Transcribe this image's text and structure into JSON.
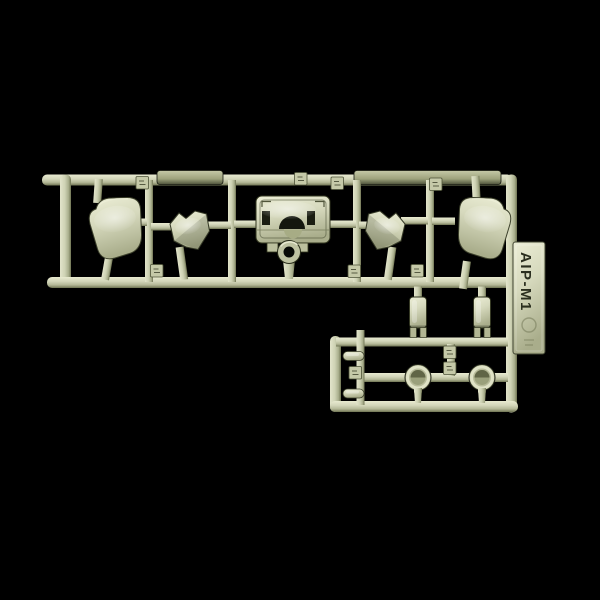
{
  "scene": {
    "description": "photograph of a plastic model kit sprue on black background",
    "background": "#000000"
  },
  "colors": {
    "plastic_light": "#e6e8cf",
    "plastic_mid": "#ced2b4",
    "plastic_shadow": "#75795a",
    "plastic_dark_edge": "#2e3220",
    "engraved_text": "#2b2f1f"
  },
  "sprue": {
    "label": "AIP-M1",
    "part_number_tags": 10,
    "parts": [
      "curved-panel-left",
      "angled-bracket-left",
      "hull-plate-center",
      "angled-bracket-right",
      "curved-panel-right",
      "box-part-left",
      "box-part-right",
      "round-hatch-left",
      "round-hatch-right",
      "capsule-part-top",
      "capsule-part-bottom"
    ]
  }
}
